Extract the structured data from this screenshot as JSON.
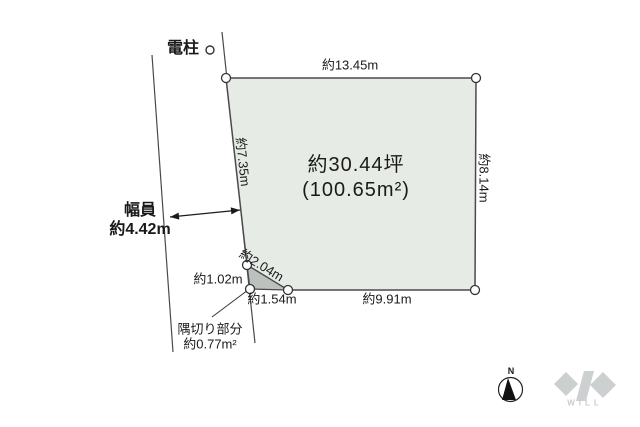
{
  "diagram": {
    "pole_label": "電柱",
    "edges": {
      "top": "約13.45m",
      "right": "約8.14m",
      "left": "約7.35m",
      "bottom": "約9.91m"
    },
    "area": {
      "tsubo": "約30.44坪",
      "sqm": "(100.65m²)"
    },
    "road_width": {
      "line1": "幅員",
      "line2": "約4.42m"
    },
    "corner_cut": {
      "left_edge": "約1.02m",
      "hypotenuse": "約2.04m",
      "bottom_edge": "約1.54m",
      "note_line1": "隅切り部分",
      "note_line2": "約0.77m²"
    },
    "compass": {
      "north": "N"
    },
    "logo": {
      "text": "WILL"
    }
  },
  "colors": {
    "plot_fill": "#e7ebe6",
    "corner_cut_fill": "#bdc1bd",
    "line": "#4a4a4a",
    "text": "#1a1a1a",
    "logo_gray": "#ccd0d0",
    "background": "#ffffff"
  }
}
